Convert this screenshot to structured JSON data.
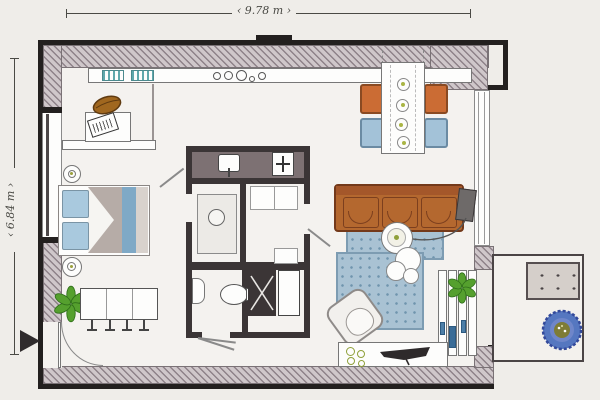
{
  "dimension_labels": {
    "width": "9.78 m",
    "height": "6.84 m"
  },
  "colors": {
    "paper": "#efede9",
    "floor": "#f4f2ef",
    "ink": "#23201f",
    "line": "#777777",
    "wall_base": "#cfc7ca",
    "wall_stripe": "#8e8289",
    "wall_edge": "#7a7276",
    "core_wall": "#3b3536",
    "core_top": "#7d7173",
    "white": "#fdfdfc",
    "teal": "#5fa8ac",
    "bag": "#a0671f",
    "pillow": "#a9c9de",
    "blanket": "#b6aca7",
    "runner": "#7fa9c6",
    "bedside": "#d8d2cd",
    "chair_orange": "#cb6c34",
    "chair_orange_dark": "#8a4a22",
    "chair_blue": "#a3c2d8",
    "chair_blue_dark": "#6b8ba3",
    "sofa": "#b4682f",
    "sofa_dark": "#73391a",
    "rug": "#a9c2d3",
    "rug_dot": "#6f95ad",
    "rug_edge": "#7d9cb2",
    "plant": "#55a02e",
    "plant_dark": "#2f6e1a",
    "plate_dot": "#a9b544",
    "lamp": "#6e6a69",
    "handle": "#4d7fa8",
    "bench": "#d5cfca",
    "flower": "#5577c0",
    "flower_mid": "#6f86c9",
    "flower_center": "#7e7c35",
    "tray": "#eceae6",
    "dim_text": "#4a4a45"
  },
  "symbols": [
    "kitchen-counter",
    "stove-burners",
    "dish-rack",
    "desk",
    "laptop",
    "bread-bag",
    "shelf",
    "bed",
    "pillow",
    "blanket",
    "bed-runner",
    "nightstand-lamp",
    "dining-table-small",
    "stool",
    "potted-plant",
    "entrance-arrow",
    "entry-door-arc",
    "window",
    "shower",
    "shower-drain",
    "toilet",
    "wash-basin",
    "sink",
    "heater",
    "wardrobe-shelves",
    "utility-shaft",
    "washing-machine",
    "door-leaf",
    "dining-table",
    "chair-orange",
    "chair-blue",
    "plate",
    "sofa",
    "seat-cushion",
    "floor-lamp",
    "lamp-cable",
    "rug",
    "coffee-table",
    "side-table",
    "armchair",
    "tv",
    "tv-sideboard",
    "decor-bowl",
    "sliding-door-panel",
    "door-handle",
    "balcony",
    "bench",
    "potted-flower"
  ]
}
